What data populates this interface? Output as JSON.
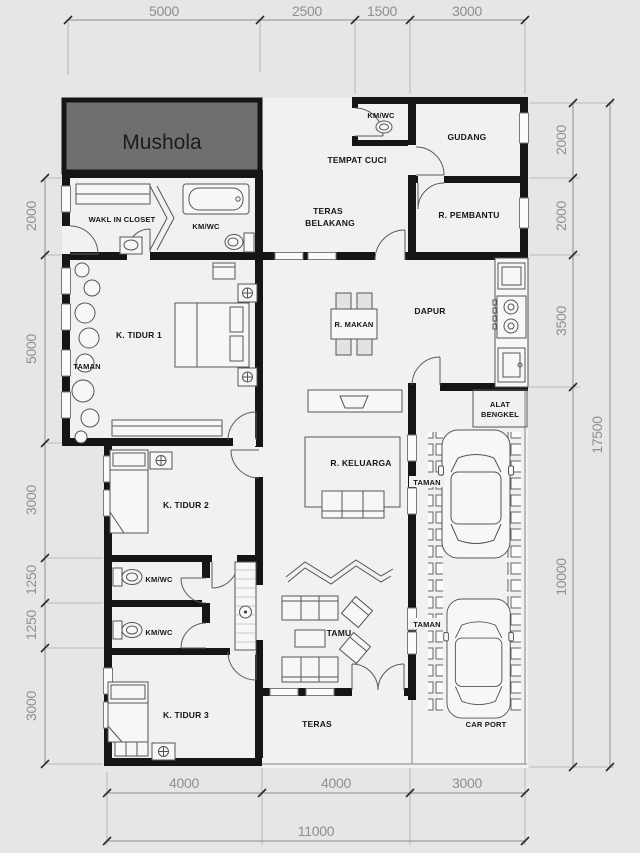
{
  "plan": {
    "rooms": {
      "mushola": "Mushola",
      "kmwc_top": "KM/WC",
      "gudang": "GUDANG",
      "tempat_cuci": "TEMPAT CUCI",
      "teras_belakang_line1": "TERAS",
      "teras_belakang_line2": "BELAKANG",
      "r_pembantu": "R. PEMBANTU",
      "wakl_in_closet": "WAKL IN CLOSET",
      "kmwc_main": "KM/WC",
      "k_tidur_1": "K. TIDUR 1",
      "taman_left": "TAMAN",
      "r_makan": "R. MAKAN",
      "dapur": "DAPUR",
      "alat_bengkel_line1": "ALAT",
      "alat_bengkel_line2": "BENGKEL",
      "r_keluarga": "R. KELUARGA",
      "taman_right_upper": "TAMAN",
      "k_tidur_2": "K. TIDUR 2",
      "kmwc_1": "KM/WC",
      "kmwc_2": "KM/WC",
      "tamu": "TAMU",
      "taman_right_lower": "TAMAN",
      "k_tidur_3": "K. TIDUR 3",
      "teras": "TERAS",
      "car_port": "CAR PORT"
    },
    "dimensions": {
      "top": [
        "5000",
        "2500",
        "1500",
        "3000"
      ],
      "bottom": [
        "4000",
        "4000",
        "3000"
      ],
      "bottom_total": "11000",
      "left": [
        "2000",
        "5000",
        "3000",
        "1250",
        "1250",
        "3000"
      ],
      "right": [
        "2000",
        "2000",
        "3500",
        "10000"
      ],
      "right_total": "17500"
    },
    "colors": {
      "background": "#e6e6e5",
      "room_fill": "#f1f1f0",
      "wall": "#151515",
      "mushola_fill": "#6f6f6f",
      "dimension_text": "#8f8f8f"
    }
  }
}
